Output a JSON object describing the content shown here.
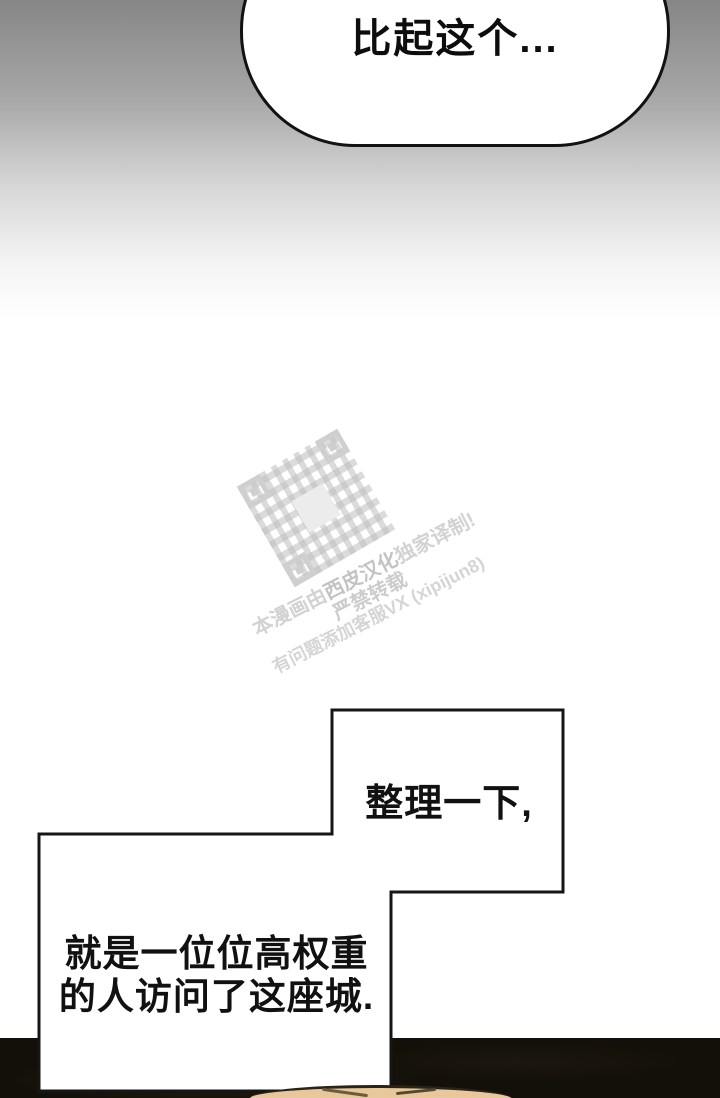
{
  "bubble_top": {
    "text": "比起这个..."
  },
  "box_mid": {
    "text": "整理一下,"
  },
  "box_bottom": {
    "line1": "就是一位位高权重",
    "line2": "的人访问了这座城."
  },
  "watermark": {
    "line1_pre": "本漫画由",
    "line1_name": "西皮汉化",
    "line1_post": "独家译制!",
    "line2": "严禁转载",
    "line3": "有问题添加客服VX (xipijun8)",
    "icon": "qr-code-icon",
    "color": "#d2d2d2"
  },
  "colors": {
    "background_top": "#868686",
    "background_mid": "#ffffff",
    "panel_dark": "#131009",
    "outline": "#161616",
    "head_skin": "#e8c89a"
  }
}
